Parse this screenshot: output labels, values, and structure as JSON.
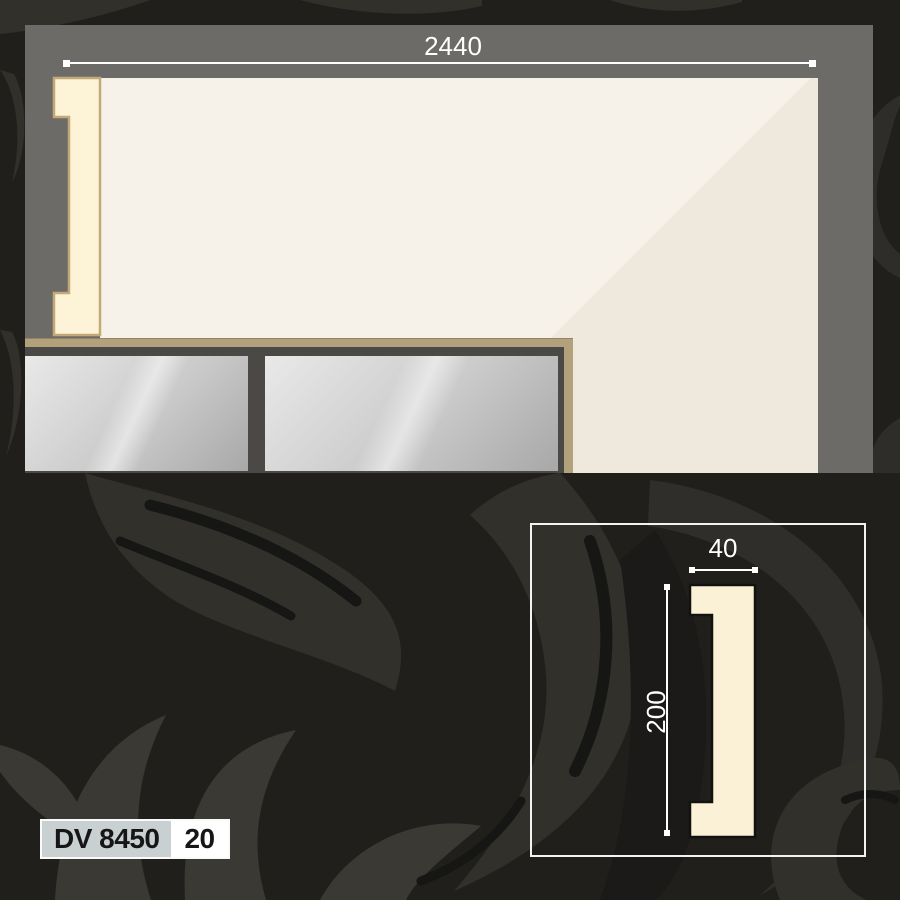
{
  "product": {
    "code": "DV 8450",
    "variant_code": "20"
  },
  "main_view": {
    "width_dimension": "2440"
  },
  "cross_section": {
    "width_dimension": "40",
    "height_dimension": "200"
  },
  "colors": {
    "background": "#201f1c",
    "damask_swirl": "#31302b",
    "damask_swirl_light": "#3a3934",
    "damask_cut": "#161614",
    "frame_gray": "#6d6b68",
    "wall_white": "#f6f2ea",
    "wall_shadow": "#efe8dc",
    "molding_cream": "#fdf4d7",
    "molding_edge_tan": "#c3a878",
    "counter_tan": "#b2a17a",
    "cabinet_gray": "#4b4946",
    "panel_silver_light": "#e9e9e9",
    "panel_silver_dark": "#a8a8a8",
    "dimension_white": "#ffffff",
    "label_code_bg": "#c9d0d2",
    "label_variant_bg": "#ffffff",
    "label_text": "#161616",
    "section_fill": "#faf1d6",
    "section_outline": "#121210"
  }
}
